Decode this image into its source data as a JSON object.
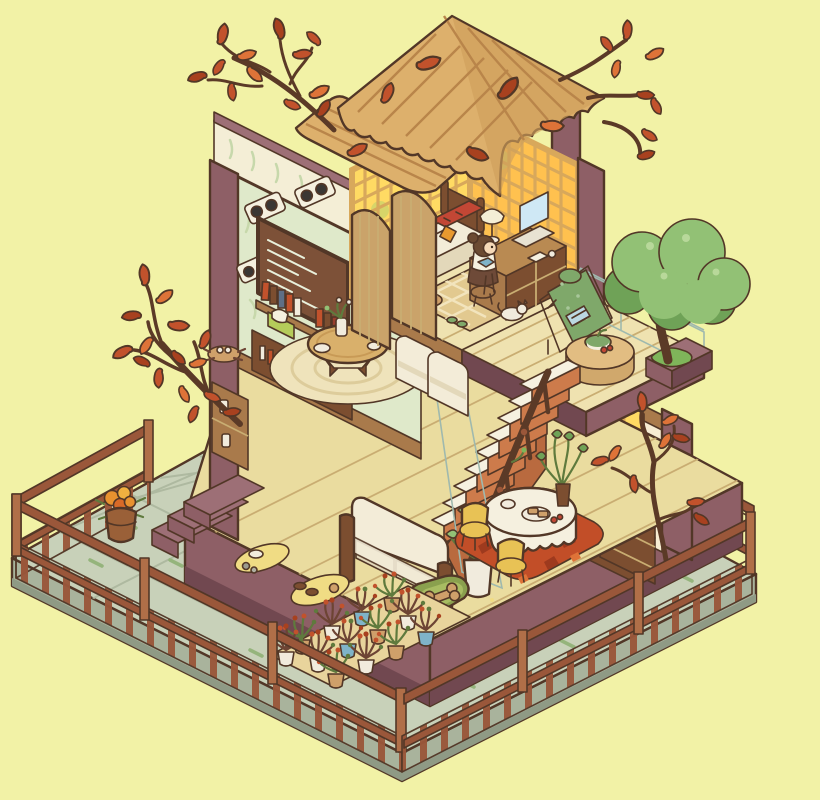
{
  "scene": {
    "description": "Isometric cutaway illustration of a cozy two-story autumn house on a stone terrace",
    "visible_text": "none (chalkboard and menu board carry illegible chalk scribbles only)",
    "elements": [
      "corrugated-roof",
      "autumn-branch-trees",
      "green-tree",
      "stone-terrace",
      "wooden-fence",
      "entry-steps",
      "flower-barrel",
      "bedroom: lattice glow windows, bed with red blanket, desk with laptop and lamp, girl character, patterned rug, white cat",
      "living-room: mint leaf wall, wall speakers, chalk menu board, book shelf, round table with vase, round woven rug, folding screens",
      "balcony: lounge chair, round pouf with fruit bowl, glass railing, tree planter",
      "ground-floor: green chalkboard, shelf pillars with jars, wainscot counter, cabinets, kitchen glow windows, cluttered kitchen counter, vinyl records, dining table with cloth, yellow chairs, autumn leaf rug, cream sofa, potted plants, pet bed with bone, floor mats with shoes",
      "terrace-front: mat with many potted plants"
    ]
  },
  "palette": {
    "bg": "#f2f2a6",
    "outline": "#523727",
    "terrace_top": "#c8d1b9",
    "terrace_side": "#a9b39c",
    "terrace_dark": "#8f9a85",
    "tile_line": "#aeb9a0",
    "moss": "#95b47c",
    "fence": "#9a573a",
    "fence_light": "#b06f48",
    "fence_dark": "#643622",
    "mauve": "#8e5f66",
    "mauve_light": "#9d6f76",
    "mauve_dark": "#714850",
    "wood_floor": "#eadc9f",
    "wood_floor_upper": "#efe2b0",
    "wood_line": "#c9ad72",
    "wall_mint": "#dfe9ca",
    "wall_pale": "#e7eed6",
    "leaf_motif": "#c7d8ab",
    "wall_cream": "#f4eed6",
    "chalk_green": "#30604a",
    "chalk": "#e9f1dc",
    "wood_mid": "#a97a4b",
    "wood_dark": "#7c4e30",
    "table_wood": "#d9b06b",
    "screen_wood": "#caa36a",
    "counter_white": "#f5f0df",
    "glow": "#ffda63",
    "glow_deep": "#ffc14f",
    "lattice_frame": "#d8a85b",
    "tread": "#f6f1e0",
    "stair_riser": "#cd7b4b",
    "stair_side": "#b96a3f",
    "sofa": "#f3ecd8",
    "sofa_shade": "#e3d8ba",
    "rug_cream": "#efe3bb",
    "rug_ring": "#ddcc9b",
    "leaf_rug": "#c24e28",
    "leaf_rug_dark": "#9e3a1e",
    "autumn": "#c2522c",
    "autumn_light": "#de7338",
    "autumn_deep": "#a8411f",
    "branch": "#5b3a27",
    "tree_green": "#92c175",
    "tree_green_dark": "#6fa257",
    "grass": "#7fb55a",
    "glass": "rgba(214,238,232,0.55)",
    "glass_line": "#9fb9ae",
    "gold_mat": "#f0dc84",
    "blue_accent": "#7fb3c8",
    "red_accent": "#c24735",
    "yellow_chair": "#e8c255",
    "pot_tan": "#cfa06a",
    "pot_white": "#f1ebdd",
    "plant_dark": "#6d4434",
    "plant_green": "#5f7a3d",
    "skin": "#f5d9b8",
    "hair": "#6b4a32",
    "cushion_green": "#7fa86a",
    "roof": "#ddb06c",
    "roof_dark": "#d0a05c",
    "roof_line": "#b9854a"
  }
}
